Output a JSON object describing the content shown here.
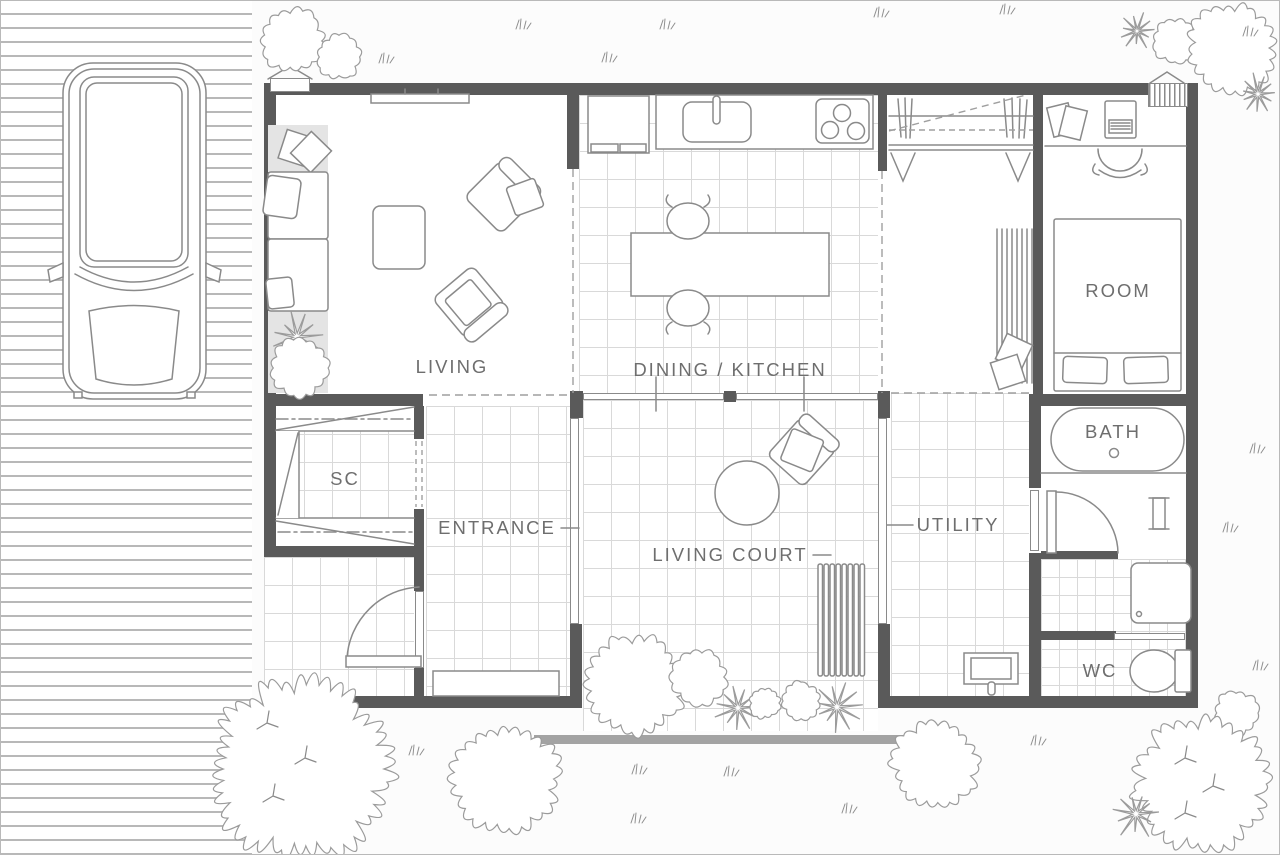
{
  "plan": {
    "type": "floor-plan",
    "labels": {
      "living": "LIVING",
      "dining_kitchen": "DINING / KITCHEN",
      "room": "ROOM",
      "sc": "SC",
      "entrance": "ENTRANCE",
      "living_court": "LIVING COURT",
      "utility": "UTILITY",
      "bath": "BATH",
      "wc": "WC"
    },
    "colors": {
      "wall": "#5a5a5a",
      "outline": "#8a8a8a",
      "tile_line": "#d9d9d9",
      "label_text": "#6e6e6e",
      "accent_fill": "#e4e4e4",
      "step_bar": "#a3a3a3",
      "background": "#fcfcfc"
    },
    "icons": {
      "car": "car-top-view-icon",
      "round_tree": "round-tree-icon",
      "spiky_shrub": "spiky-shrub-icon",
      "grass": "grass-tuft-icon",
      "sofa": "sofa-icon",
      "armchair": "armchair-icon",
      "coffee_table": "coffee-table-icon",
      "tv": "tv-icon",
      "refrigerator": "refrigerator-icon",
      "kitchen_sink": "sink-icon",
      "cooktop": "cooktop-icon",
      "dining_table": "dining-table-icon",
      "chair": "chair-icon",
      "wardrobe_rod": "wardrobe-rod-icon",
      "desk": "desk-icon",
      "laptop": "laptop-icon",
      "bed": "bed-icon",
      "door": "door-swing-icon",
      "bench": "bench-icon",
      "bathtub": "bathtub-icon",
      "washer": "washing-machine-icon",
      "toilet": "toilet-icon",
      "utility_sink": "utility-sink-icon"
    }
  }
}
